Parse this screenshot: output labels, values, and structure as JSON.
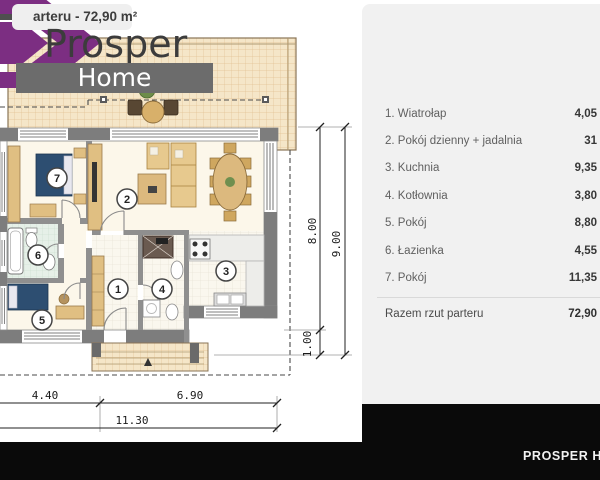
{
  "badge": {
    "title": "arteru - 72,90 m²"
  },
  "watermark": {
    "brand": "Prosper",
    "sub": "Home"
  },
  "panel": {
    "rooms": [
      {
        "label": "1. Wiatrołap",
        "area": "4,05"
      },
      {
        "label": "2. Pokój dzienny + jadalnia",
        "area": "31"
      },
      {
        "label": "3. Kuchnia",
        "area": "9,35"
      },
      {
        "label": "4. Kotłownia",
        "area": "3,80"
      },
      {
        "label": "5. Pokój",
        "area": "8,80"
      },
      {
        "label": "6. Łazienka",
        "area": "4,55"
      },
      {
        "label": "7. Pokój",
        "area": "11,35"
      }
    ],
    "total": {
      "label": "Razem rzut parteru",
      "area": "72,90"
    }
  },
  "footer": {
    "brand": "PROSPER HOME"
  },
  "plan": {
    "room_numbers": [
      "1",
      "2",
      "3",
      "4",
      "5",
      "6",
      "7"
    ],
    "dimensions": {
      "bottom_left": "4.40",
      "bottom_right": "6.90",
      "bottom_total": "11.30",
      "side_inner": "8.00",
      "side_total": "9.00",
      "porch_depth": "1.00"
    }
  },
  "colors": {
    "accent_purple": "#7c2e82",
    "panel_bg": "#f1f1f1",
    "footer_bg": "#0a0a0a",
    "wall_gray": "#7d7d7d",
    "terrace_beige": "#f5e6c8",
    "bed_navy": "#2d4e71",
    "furniture_tan": "#e0bf82"
  }
}
